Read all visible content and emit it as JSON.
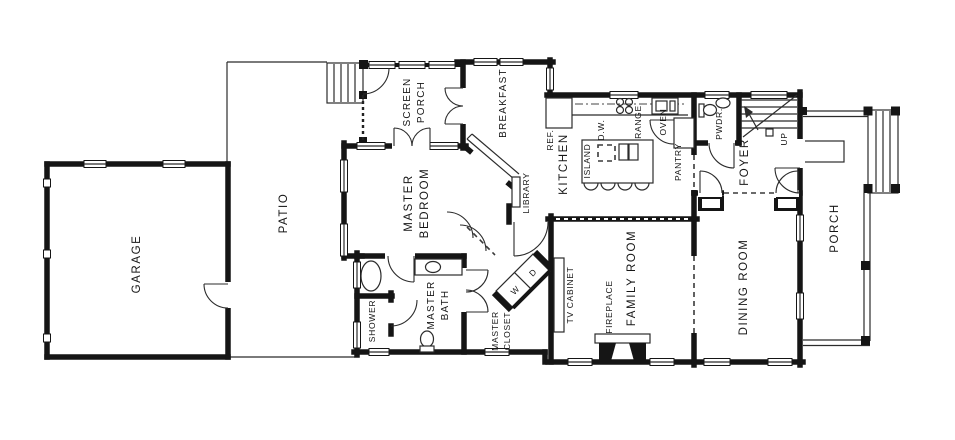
{
  "labels": {
    "garage": "GARAGE",
    "patio": "PATIO",
    "screen_porch_1": "SCREEN",
    "screen_porch_2": "PORCH",
    "breakfast": "BREAKFAST",
    "master_bedroom_1": "MASTER",
    "master_bedroom_2": "BEDROOM",
    "library": "LIBRARY",
    "kitchen": "KITCHEN",
    "island": "ISLAND",
    "dishwasher": "D.W.",
    "refrigerator": "REF.",
    "range": "RANGE",
    "oven": "OVEN",
    "pantry": "PANTRY",
    "powder": "PWDR.",
    "foyer": "FOYER",
    "stairs_up": "UP",
    "porch": "PORCH",
    "dining_room": "DINING ROOM",
    "family_room": "FAMILY ROOM",
    "fireplace": "FIREPLACE",
    "tv_cabinet": "TV CABINET",
    "master_bath_1": "MASTER",
    "master_bath_2": "BATH",
    "master_closet_1": "MASTER",
    "master_closet_2": "CLOSET",
    "shower": "SHOWER",
    "washer": "W",
    "dryer": "D"
  },
  "colors": {
    "background": "#ffffff",
    "walls": "#151515",
    "thin_lines": "#2b2b2b",
    "text": "#161616"
  }
}
